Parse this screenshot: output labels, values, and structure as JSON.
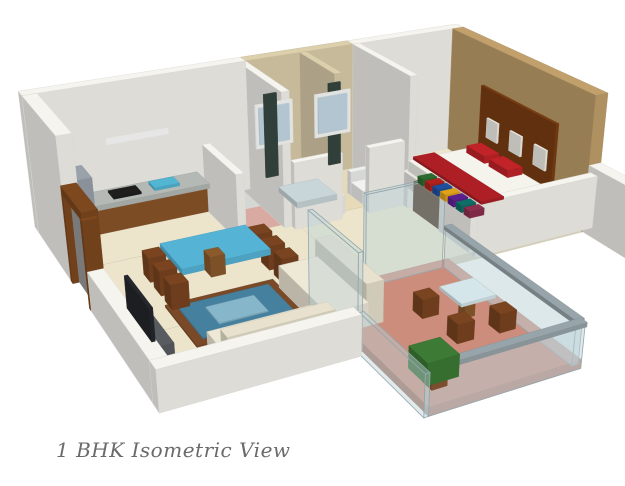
{
  "caption": "1 BHK Isometric View",
  "colors": {
    "background": "#ffffff",
    "caption_text": "#6a6a6a",
    "wall_white": "#f5f4ef",
    "floor_cream": "#ece5cc",
    "floor_utility_pink": "#d9aaa1",
    "floor_bath_tile": "#e6dab8",
    "floor_balcony_terracotta": "#cd8d7c",
    "wall_bath_tile": "#dccfac",
    "wall_bedroom_tan": "#c1a06c",
    "headboard_brown": "#7c3e13",
    "bedding_red": "#c12328",
    "cabinet_wood": "#8a5429",
    "table_glass_blue": "#55b4d6",
    "rug_blue": "#46809f",
    "rug_border_brown": "#7a4a28",
    "railing_glass": "#bcd2d8",
    "plant_green": "#3c7a35"
  },
  "camera": {
    "pos": [
      -232,
      1050,
      503
    ],
    "fwd": [
      0.42,
      -0.8,
      -0.43
    ],
    "right": [
      0.886,
      0.465,
      0
    ],
    "up": [
      0.2,
      -0.381,
      0.904
    ],
    "f": 1180,
    "cx": 342,
    "cy": 221
  },
  "scene": {
    "boxes": [
      {
        "n": "kitchen-floor",
        "x": 0,
        "y": 0,
        "w": 150,
        "d": 110,
        "z": 0,
        "h": 8,
        "c": "#ece5cc",
        "l": 0
      },
      {
        "n": "utility-floor",
        "x": 150,
        "y": 0,
        "w": 60,
        "d": 110,
        "z": 0,
        "h": 8,
        "c": "#d9aaa1",
        "l": 0
      },
      {
        "n": "bathroom-floor",
        "x": 210,
        "y": 0,
        "w": 130,
        "d": 110,
        "z": 0,
        "h": 8,
        "c": "#e6dab8",
        "l": 0
      },
      {
        "n": "hallway-floor",
        "x": 210,
        "y": 110,
        "w": 122,
        "d": 135,
        "z": 0,
        "h": 8,
        "c": "#ece5cc",
        "l": 0
      },
      {
        "n": "bedroom-floor",
        "x": 332,
        "y": 0,
        "w": 137,
        "d": 245,
        "z": 0,
        "h": 8,
        "c": "#ece5cc",
        "l": 0
      },
      {
        "n": "living-floor",
        "x": 0,
        "y": 110,
        "w": 210,
        "d": 135,
        "z": 0,
        "h": 8,
        "c": "#ece5cc",
        "l": 0
      },
      {
        "n": "living-floor-south",
        "x": 0,
        "y": 245,
        "w": 160,
        "d": 85,
        "z": 0,
        "h": 8,
        "c": "#ece5cc",
        "l": 0
      },
      {
        "n": "balcony-floor",
        "x": 160,
        "y": 245,
        "w": 140,
        "d": 195,
        "z": 0,
        "h": 8,
        "c": "#cd8d7c",
        "l": 0
      },
      {
        "n": "living-rug-border",
        "x": 40,
        "y": 210,
        "w": 100,
        "d": 74,
        "z": 8,
        "h": 2,
        "c": "#7a4a28",
        "l": 0.5
      },
      {
        "n": "living-rug-field",
        "x": 48,
        "y": 218,
        "w": 84,
        "d": 58,
        "z": 10,
        "h": 1,
        "c": "#46809f",
        "l": 0.5
      },
      {
        "n": "living-rug-medallion",
        "x": 68,
        "y": 232,
        "w": 44,
        "d": 30,
        "z": 11,
        "h": 1,
        "c": "#86b6c9",
        "l": 0.5
      },
      {
        "n": "bedroom-rug",
        "x": 336,
        "y": 20,
        "w": 18,
        "d": 100,
        "z": 8,
        "h": 2,
        "c": "#d8c290",
        "l": 0.5
      },
      {
        "n": "bedroom-north-wall",
        "x": 332,
        "y": -14,
        "w": 137,
        "d": 14,
        "z": 0,
        "h": 140,
        "c": "#f5f4ef"
      },
      {
        "n": "bathroom-north-wall",
        "x": 210,
        "y": -14,
        "w": 122,
        "d": 14,
        "z": 0,
        "h": 140,
        "c": "#dccfac"
      },
      {
        "n": "kitchen-north-wall",
        "x": -14,
        "y": -14,
        "w": 224,
        "d": 14,
        "z": 0,
        "h": 140,
        "c": "#f5f4ef"
      },
      {
        "n": "kitchen-west-wall",
        "x": -14,
        "y": 0,
        "w": 14,
        "d": 115,
        "z": 0,
        "h": 140,
        "c": "#f5f4ef"
      },
      {
        "n": "bedroom-east-wall",
        "x": 455,
        "y": 0,
        "w": 14,
        "d": 245,
        "z": 0,
        "h": 140,
        "c": "#c1a06c"
      },
      {
        "n": "bathroom-west-wall",
        "x": 202,
        "y": 0,
        "w": 8,
        "d": 102,
        "z": 0,
        "h": 140,
        "c": "#f5f4ef"
      },
      {
        "n": "bathroom-divider-wall",
        "x": 270,
        "y": 0,
        "w": 8,
        "d": 78,
        "z": 0,
        "h": 140,
        "c": "#dccfac"
      },
      {
        "n": "bathroom-south-wall-west",
        "x": 210,
        "y": 102,
        "w": 52,
        "d": 8,
        "z": 0,
        "h": 70,
        "c": "#f5f4ef"
      },
      {
        "n": "bathroom-south-wall-east",
        "x": 292,
        "y": 102,
        "w": 40,
        "d": 8,
        "z": 0,
        "h": 70,
        "c": "#f5f4ef"
      },
      {
        "n": "bedroom-west-wall",
        "x": 332,
        "y": 0,
        "w": 8,
        "d": 118,
        "z": 0,
        "h": 140,
        "c": "#f5f4ef"
      },
      {
        "n": "bedroom-west-wall-south",
        "x": 332,
        "y": 178,
        "w": 8,
        "d": 54,
        "z": 0,
        "h": 70,
        "c": "#f5f4ef"
      },
      {
        "n": "bedroom-south-wall",
        "x": 332,
        "y": 232,
        "w": 137,
        "d": 10,
        "z": 0,
        "h": 55,
        "c": "#f5f4ef"
      },
      {
        "n": "kitchen-utility-divider",
        "x": 150,
        "y": 25,
        "w": 8,
        "d": 85,
        "z": 0,
        "h": 70,
        "c": "#f5f4ef"
      },
      {
        "n": "entry-door-post-north",
        "x": -14,
        "y": 112,
        "w": 14,
        "d": 6,
        "z": 0,
        "h": 85,
        "c": "#7e481f"
      },
      {
        "n": "entry-door-post-south",
        "x": -14,
        "y": 168,
        "w": 14,
        "d": 6,
        "z": 0,
        "h": 85,
        "c": "#7e481f"
      },
      {
        "n": "entry-door-lintel",
        "x": -14,
        "y": 112,
        "w": 14,
        "d": 62,
        "z": 85,
        "h": 8,
        "c": "#7e481f"
      },
      {
        "n": "entry-door-panel",
        "x": -8,
        "y": 118,
        "w": 6,
        "d": 48,
        "z": 0,
        "h": 80,
        "c": "#9b9b9b"
      },
      {
        "n": "living-west-wall",
        "x": -14,
        "y": 174,
        "w": 14,
        "d": 160,
        "z": 0,
        "h": 38,
        "c": "#f5f4ef"
      },
      {
        "n": "living-south-wall",
        "x": -14,
        "y": 330,
        "w": 170,
        "d": 14,
        "z": 0,
        "h": 38,
        "c": "#f5f4ef"
      },
      {
        "n": "se-outer-wall",
        "x": 455,
        "y": 245,
        "w": 14,
        "d": 100,
        "z": 0,
        "h": 70,
        "c": "#f5f4ef"
      },
      {
        "n": "balcony-door-glass-west",
        "x": 156,
        "y": 250,
        "w": 4,
        "d": 88,
        "z": 0,
        "h": 90,
        "c": "#bcd2d8",
        "o": 0.45
      },
      {
        "n": "balcony-west-rail-glass",
        "x": 156,
        "y": 340,
        "w": 4,
        "d": 100,
        "z": 0,
        "h": 38,
        "c": "#bcd2d8",
        "o": 0.45
      },
      {
        "n": "balcony-north-glass-door",
        "x": 214,
        "y": 241,
        "w": 80,
        "d": 4,
        "z": 0,
        "h": 90,
        "c": "#bcd2d8",
        "o": 0.45
      },
      {
        "n": "balcony-south-rail-glass",
        "x": 160,
        "y": 434,
        "w": 140,
        "d": 6,
        "z": 0,
        "h": 38,
        "c": "#bcd2d8",
        "o": 0.5
      },
      {
        "n": "balcony-south-rail-cap",
        "x": 159,
        "y": 433,
        "w": 142,
        "d": 8,
        "z": 38,
        "h": 4,
        "c": "#97a4a9"
      },
      {
        "n": "balcony-east-rail-glass",
        "x": 296,
        "y": 245,
        "w": 6,
        "d": 189,
        "z": 0,
        "h": 38,
        "c": "#bcd2d8",
        "o": 0.5
      },
      {
        "n": "balcony-east-rail-cap",
        "x": 295,
        "y": 244,
        "w": 8,
        "d": 191,
        "z": 38,
        "h": 4,
        "c": "#97a4a9"
      },
      {
        "n": "refrigerator",
        "x": 0,
        "y": 2,
        "w": 34,
        "d": 34,
        "z": 0,
        "h": 62,
        "c": "#99a1ab"
      },
      {
        "n": "kitchen-cabinets",
        "x": 36,
        "y": 2,
        "w": 114,
        "d": 30,
        "z": 0,
        "h": 26,
        "c": "#8a5429"
      },
      {
        "n": "kitchen-countertop",
        "x": 34,
        "y": 0,
        "w": 118,
        "d": 34,
        "z": 26,
        "h": 5,
        "c": "#b4b9b5"
      },
      {
        "n": "kitchen-stove",
        "x": 56,
        "y": 8,
        "w": 28,
        "d": 18,
        "z": 31,
        "h": 2,
        "c": "#1e1e1e",
        "l": 2
      },
      {
        "n": "kitchen-sink",
        "x": 98,
        "y": 7,
        "w": 26,
        "d": 18,
        "z": 31,
        "h": 3,
        "c": "#52b6d3",
        "l": 2
      },
      {
        "n": "kitchen-light",
        "x": 60,
        "y": 0.5,
        "w": 64,
        "d": 1.5,
        "z": 78,
        "h": 6,
        "c": "#ffffff",
        "l": 2
      },
      {
        "n": "washing-machine",
        "x": 162,
        "y": 4,
        "w": 40,
        "d": 40,
        "z": 0,
        "h": 52,
        "c": "#edefec"
      },
      {
        "n": "bathtub",
        "x": 214,
        "y": 44,
        "w": 56,
        "d": 56,
        "z": 0,
        "h": 20,
        "c": "#eef0ee"
      },
      {
        "n": "bathtub-basin",
        "x": 220,
        "y": 50,
        "w": 44,
        "d": 44,
        "z": 14,
        "h": 6,
        "c": "#c9d6d9",
        "l": 2
      },
      {
        "n": "toilet-tank",
        "x": 296,
        "y": 56,
        "w": 20,
        "d": 8,
        "z": 0,
        "h": 26,
        "c": "#eef0ee"
      },
      {
        "n": "toilet",
        "x": 296,
        "y": 64,
        "w": 20,
        "d": 26,
        "z": 0,
        "h": 15,
        "c": "#f2f3f1"
      },
      {
        "n": "shower-panel-1",
        "x": 228,
        "y": 0.5,
        "w": 14,
        "d": 2,
        "z": 10,
        "h": 92,
        "c": "#35463f",
        "l": 2
      },
      {
        "n": "shower-panel-2",
        "x": 302,
        "y": 0.5,
        "w": 14,
        "d": 2,
        "z": 10,
        "h": 92,
        "c": "#35463f",
        "l": 2
      },
      {
        "n": "bath-window-frame-1",
        "x": 218,
        "y": 0.3,
        "w": 42,
        "d": 1.8,
        "z": 44,
        "h": 48,
        "c": "#fbfbf9",
        "l": 2
      },
      {
        "n": "bath-window-glass-1",
        "x": 222,
        "y": 0.5,
        "w": 34,
        "d": 1.8,
        "z": 48,
        "h": 40,
        "c": "#c6dbe7",
        "l": 2
      },
      {
        "n": "bath-window-frame-2",
        "x": 286,
        "y": 0.3,
        "w": 42,
        "d": 1.8,
        "z": 44,
        "h": 48,
        "c": "#fbfbf9",
        "l": 2
      },
      {
        "n": "bath-window-glass-2",
        "x": 290,
        "y": 0.5,
        "w": 34,
        "d": 1.8,
        "z": 48,
        "h": 40,
        "c": "#c6dbe7",
        "l": 2
      },
      {
        "n": "dining-table-pedestal",
        "x": 100,
        "y": 148,
        "w": 14,
        "d": 16,
        "z": 0,
        "h": 20,
        "c": "#8a5a2b"
      },
      {
        "n": "dining-table-top",
        "x": 66,
        "y": 128,
        "w": 84,
        "d": 56,
        "z": 20,
        "h": 6,
        "c": "#55b4d6"
      },
      {
        "n": "dining-chair-1",
        "x": 48,
        "y": 130,
        "w": 16,
        "d": 18,
        "z": 0,
        "h": 24,
        "c": "#7a4420"
      },
      {
        "n": "dining-chair-2",
        "x": 48,
        "y": 158,
        "w": 16,
        "d": 18,
        "z": 0,
        "h": 24,
        "c": "#7a4420"
      },
      {
        "n": "dining-chair-3",
        "x": 48,
        "y": 186,
        "w": 16,
        "d": 18,
        "z": 0,
        "h": 24,
        "c": "#7a4420"
      },
      {
        "n": "dining-chair-4",
        "x": 152,
        "y": 130,
        "w": 16,
        "d": 18,
        "z": 0,
        "h": 24,
        "c": "#7a4420"
      },
      {
        "n": "dining-chair-5",
        "x": 152,
        "y": 158,
        "w": 16,
        "d": 18,
        "z": 0,
        "h": 24,
        "c": "#7a4420"
      },
      {
        "n": "dining-chair-6",
        "x": 152,
        "y": 186,
        "w": 16,
        "d": 18,
        "z": 0,
        "h": 24,
        "c": "#7a4420"
      },
      {
        "n": "tv-unit",
        "x": 2,
        "y": 215,
        "w": 16,
        "d": 78,
        "z": 0,
        "h": 24,
        "c": "#585c61"
      },
      {
        "n": "tv-screen",
        "x": 3,
        "y": 224,
        "w": 3,
        "d": 60,
        "z": 24,
        "h": 30,
        "c": "#24272b",
        "l": 2
      },
      {
        "n": "sofa-back-1",
        "x": 182,
        "y": 210,
        "w": 16,
        "d": 95,
        "z": 0,
        "h": 40,
        "c": "#e7e1cd"
      },
      {
        "n": "sofa-seat-1",
        "x": 146,
        "y": 210,
        "w": 38,
        "d": 95,
        "z": 0,
        "h": 22,
        "c": "#eee8d6"
      },
      {
        "n": "sofa-back-2",
        "x": 48,
        "y": 316,
        "w": 92,
        "d": 14,
        "z": 0,
        "h": 40,
        "c": "#e7e1cd"
      },
      {
        "n": "sofa-seat-2",
        "x": 48,
        "y": 286,
        "w": 92,
        "d": 32,
        "z": 0,
        "h": 22,
        "c": "#eee8d6"
      },
      {
        "n": "bed-headboard-panel",
        "x": 451,
        "y": 66,
        "w": 3,
        "d": 130,
        "z": 24,
        "h": 72,
        "c": "#7c3e13"
      },
      {
        "n": "headboard-art-1",
        "x": 450.5,
        "y": 80,
        "w": 2,
        "d": 20,
        "z": 42,
        "h": 22,
        "c": "#f4f2ea",
        "l": 2
      },
      {
        "n": "headboard-art-2",
        "x": 450.5,
        "y": 122,
        "w": 2,
        "d": 20,
        "z": 42,
        "h": 22,
        "c": "#f4f2ea",
        "l": 2
      },
      {
        "n": "headboard-art-3",
        "x": 450.5,
        "y": 164,
        "w": 2,
        "d": 20,
        "z": 42,
        "h": 22,
        "c": "#f4f2ea",
        "l": 2
      },
      {
        "n": "bed-base",
        "x": 358,
        "y": 64,
        "w": 94,
        "d": 136,
        "z": 0,
        "h": 16,
        "c": "#e8e7e1"
      },
      {
        "n": "bed-mattress",
        "x": 362,
        "y": 68,
        "w": 86,
        "d": 128,
        "z": 16,
        "h": 12,
        "c": "#f4f3ec"
      },
      {
        "n": "bed-pillow-1",
        "x": 428,
        "y": 78,
        "w": 18,
        "d": 34,
        "z": 28,
        "h": 8,
        "c": "#c12328",
        "l": 2
      },
      {
        "n": "bed-pillow-2",
        "x": 428,
        "y": 120,
        "w": 18,
        "d": 34,
        "z": 28,
        "h": 8,
        "c": "#c12328",
        "l": 2
      },
      {
        "n": "bed-runner",
        "x": 368,
        "y": 68,
        "w": 26,
        "d": 128,
        "z": 28,
        "h": 3,
        "c": "#ad1e25",
        "l": 2
      },
      {
        "n": "bedroom-shelf",
        "x": 334,
        "y": 126,
        "w": 22,
        "d": 104,
        "z": 0,
        "h": 32,
        "c": "#49290f"
      },
      {
        "n": "shelf-book-1",
        "x": 336,
        "y": 130,
        "w": 16,
        "d": 10,
        "z": 32,
        "h": 7,
        "c": "#2e6b2f",
        "l": 2
      },
      {
        "n": "shelf-book-2",
        "x": 336,
        "y": 144,
        "w": 16,
        "d": 10,
        "z": 32,
        "h": 7,
        "c": "#b3211e",
        "l": 2
      },
      {
        "n": "shelf-book-3",
        "x": 336,
        "y": 158,
        "w": 16,
        "d": 10,
        "z": 32,
        "h": 7,
        "c": "#1d4f9c",
        "l": 2
      },
      {
        "n": "shelf-book-4",
        "x": 336,
        "y": 172,
        "w": 16,
        "d": 10,
        "z": 32,
        "h": 7,
        "c": "#e0a21b",
        "l": 2
      },
      {
        "n": "shelf-book-5",
        "x": 336,
        "y": 186,
        "w": 16,
        "d": 10,
        "z": 32,
        "h": 7,
        "c": "#5d1f8f",
        "l": 2
      },
      {
        "n": "shelf-book-6",
        "x": 336,
        "y": 200,
        "w": 16,
        "d": 10,
        "z": 32,
        "h": 7,
        "c": "#0f6f66",
        "l": 2
      },
      {
        "n": "shelf-book-7",
        "x": 336,
        "y": 214,
        "w": 16,
        "d": 10,
        "z": 32,
        "h": 7,
        "c": "#8c2f4f",
        "l": 2
      },
      {
        "n": "balcony-table-pedestal",
        "x": 262,
        "y": 322,
        "w": 10,
        "d": 10,
        "z": 0,
        "h": 20,
        "c": "#8a5a2b"
      },
      {
        "n": "balcony-table-top",
        "x": 250,
        "y": 310,
        "w": 34,
        "d": 34,
        "z": 20,
        "h": 3,
        "c": "#d5e6ea"
      },
      {
        "n": "balcony-chair-1",
        "x": 230,
        "y": 300,
        "w": 16,
        "d": 16,
        "z": 0,
        "h": 18,
        "c": "#7a4420"
      },
      {
        "n": "balcony-chair-2",
        "x": 234,
        "y": 348,
        "w": 16,
        "d": 16,
        "z": 0,
        "h": 18,
        "c": "#7a4420"
      },
      {
        "n": "balcony-chair-3",
        "x": 274,
        "y": 350,
        "w": 16,
        "d": 16,
        "z": 0,
        "h": 18,
        "c": "#7a4420"
      },
      {
        "n": "balcony-plant-pot",
        "x": 180,
        "y": 398,
        "w": 14,
        "d": 14,
        "z": 0,
        "h": 10,
        "c": "#8a5533"
      },
      {
        "n": "balcony-plant",
        "x": 172,
        "y": 390,
        "w": 28,
        "d": 28,
        "z": 10,
        "h": 20,
        "c": "#3c7a35"
      }
    ]
  }
}
